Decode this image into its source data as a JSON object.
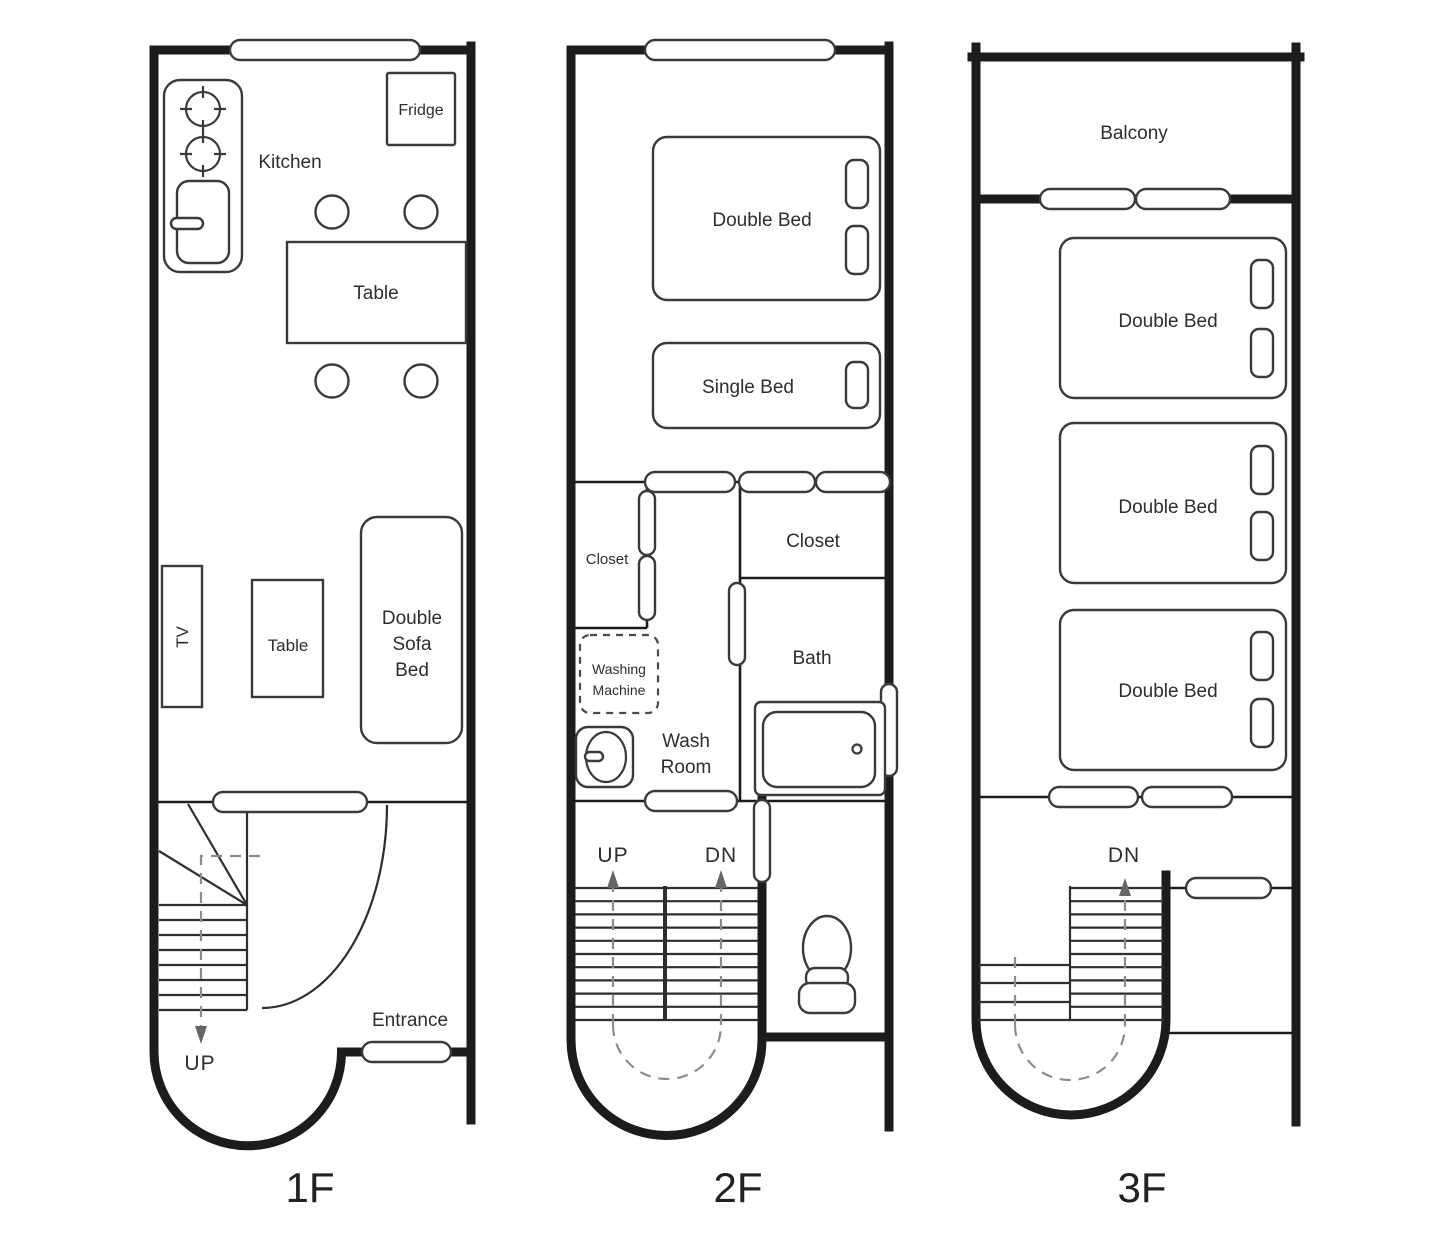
{
  "title": "Three-storey house floor plan",
  "colors": {
    "background": "#ffffff",
    "wall": "#1c1c1c",
    "fixture_stroke": "#3a3a3a",
    "text": "#2e2e2e",
    "dashed_path": "#8c8c8c"
  },
  "floors": [
    {
      "name": "1F",
      "labels": {
        "kitchen": "Kitchen",
        "fridge": "Fridge",
        "dining_table": "Table",
        "tv": "TV",
        "living_table": "Table",
        "sofa_line1": "Double",
        "sofa_line2": "Sofa",
        "sofa_line3": "Bed",
        "up": "UP",
        "entrance": "Entrance"
      }
    },
    {
      "name": "2F",
      "labels": {
        "double_bed": "Double Bed",
        "single_bed": "Single Bed",
        "closet_small": "Closet",
        "closet": "Closet",
        "bath": "Bath",
        "washing_line1": "Washing",
        "washing_line2": "Machine",
        "washroom_line1": "Wash",
        "washroom_line2": "Room",
        "up": "UP",
        "dn": "DN"
      }
    },
    {
      "name": "3F",
      "labels": {
        "balcony": "Balcony",
        "bed1": "Double Bed",
        "bed2": "Double Bed",
        "bed3": "Double Bed",
        "dn": "DN"
      }
    }
  ]
}
